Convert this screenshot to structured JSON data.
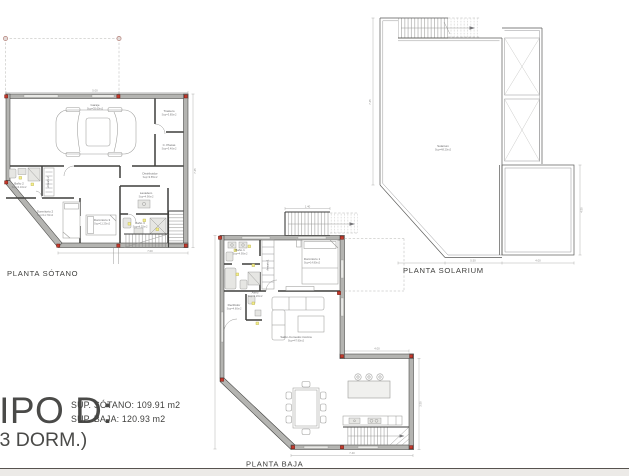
{
  "page": {
    "background": "#ffffff",
    "footer_strip_color": "#eceae7",
    "footer_line_color": "#57534f"
  },
  "title_block": {
    "type_name": "TIPO D:",
    "bedrooms": "(3 DORM.)",
    "area_sotano": "SUP. SÓTANO: 109.91 m2",
    "area_baja": "SUP. BAJA: 120.93 m2"
  },
  "colors": {
    "wall_fill": "#b4b4b1",
    "wall_edge": "#3e3e3c",
    "column_marker_red": "#c4392c",
    "light_marker_yellow": "#f4ef8d",
    "dashed_line": "#b5b5b2",
    "dimension_line": "#9f9f9d",
    "label_text": "#3d3d3b"
  },
  "plans": {
    "sotano": {
      "label": "PLANTA SÓTANO",
      "dims": {
        "top": "5.00",
        "right": "7.45",
        "bottom": "7.00"
      },
      "rooms": {
        "garaje": {
          "name": "Garaje",
          "sup": "Sup=35.60m2"
        },
        "trastero": {
          "name": "Trastero",
          "sup": "Sup=3.85m2"
        },
        "placas": {
          "name": "C. Placas",
          "sup": "Sup=3.40m2"
        },
        "bano2": {
          "name": "Baño 2",
          "sup": "Sup=4.10m2"
        },
        "armario2": {
          "name": "Armario 2"
        },
        "distribuidor": {
          "name": "Distribuidor",
          "sup": "Sup=9.85m2"
        },
        "dormitorio2": {
          "name": "Dormitorio 2",
          "sup": "Sup=11.70m2"
        },
        "dormitorio3": {
          "name": "Dormitorio 3",
          "sup": "Sup=11.25m2"
        },
        "lavadero": {
          "name": "Lavadero",
          "sup": "Sup=4.90m2"
        },
        "bano3": {
          "name": "Baño 3",
          "sup": "Sup=4.35m2"
        }
      }
    },
    "baja": {
      "label": "PLANTA BAJA",
      "dims": {
        "stairs": "1.40",
        "step": "4.00",
        "bottom": "7.40",
        "right": "3.50"
      },
      "rooms": {
        "dormitorio1": {
          "name": "Dormitorio 1",
          "sup": "Sup=14.80m2"
        },
        "bano1": {
          "name": "Baño 1",
          "sup": "Sup=4.95m2"
        },
        "armario1": {
          "name": "Armario 1"
        },
        "aseo": {
          "name": "Aseo",
          "sup": "Sup=2.20m2"
        },
        "recibidor": {
          "name": "Recibidor",
          "sup": "Sup=4.60m2"
        },
        "salon": {
          "name": "Salón-Comedor-Cocina",
          "sup": "Sup=47.90m2"
        }
      }
    },
    "solarium": {
      "label": "PLANTA SOLARIUM",
      "dims": {
        "left": "7.45",
        "bottom_left": "5.50",
        "bottom_right": "4.00",
        "right": "4.50"
      },
      "rooms": {
        "solarium": {
          "name": "Solarium",
          "sup": "Sup=48.20m2"
        }
      }
    }
  }
}
